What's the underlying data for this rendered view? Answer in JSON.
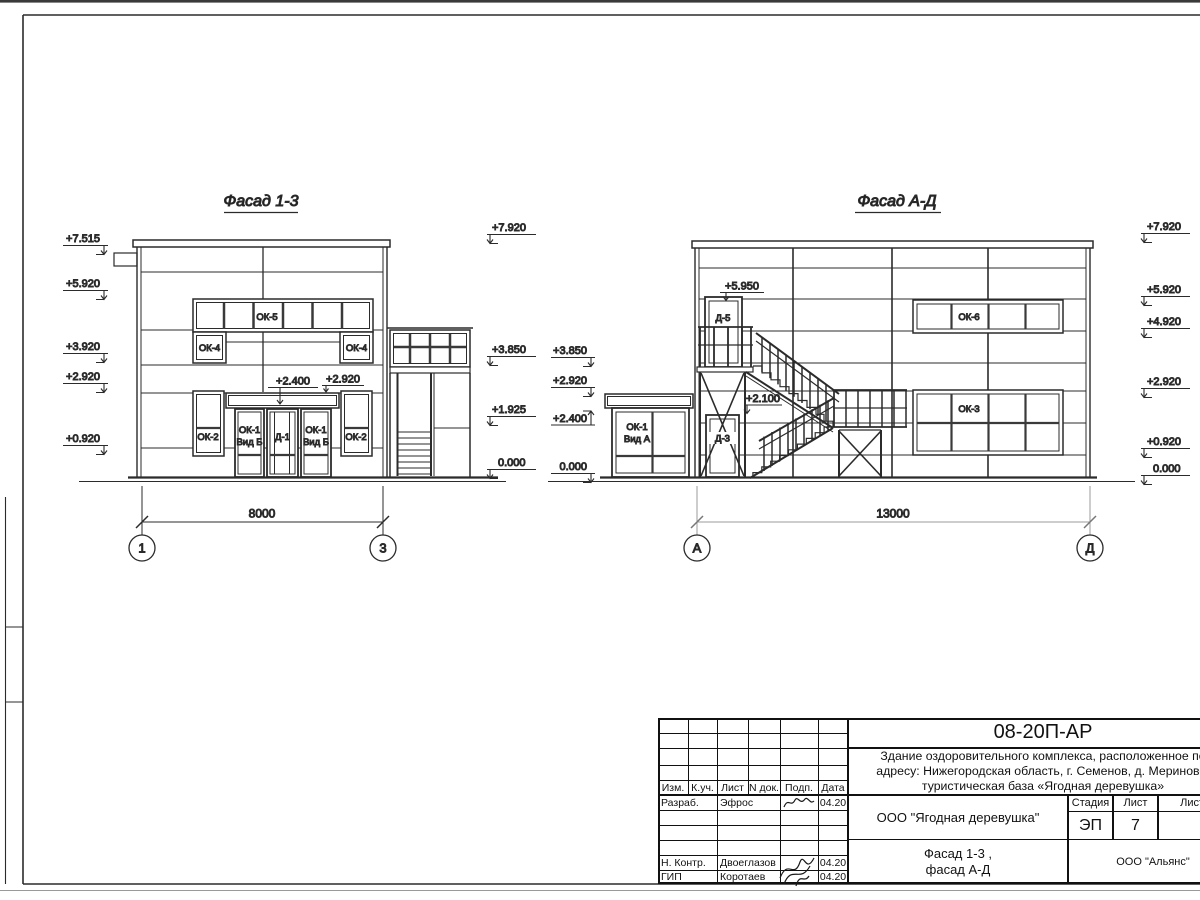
{
  "f13": {
    "title": "Фасад 1-3",
    "marks_left": [
      "+7.515",
      "+5.920",
      "+3.920",
      "+2.920",
      "+0.920"
    ],
    "marks_right": [
      "+7.920",
      "+3.850",
      "+1.925",
      "0.000"
    ],
    "mark_canopy": "+2.400",
    "mark_wall": "+2.920",
    "win_ok5": "ОК-5",
    "win_ok4": "ОК-4",
    "win_ok2": "ОК-2",
    "win_ok1_l1": "ОК-1",
    "win_ok1_l2": "Вид Б",
    "door_d1": "Д-1",
    "dim": "8000",
    "axis_left": "1",
    "axis_right": "3"
  },
  "fad": {
    "title": "Фасад А-Д",
    "marks_left": [
      "+3.850",
      "+2.920",
      "+2.400",
      "0.000"
    ],
    "marks_right": [
      "+7.920",
      "+5.920",
      "+4.920",
      "+2.920",
      "+0.920",
      "0.000"
    ],
    "mark_d5": "+5.950",
    "mark_d3": "+2.100",
    "door_d5": "Д-5",
    "door_d3": "Д-3",
    "win_ok6": "ОК-6",
    "win_ok3": "ОК-3",
    "win_ok1_l1": "ОК-1",
    "win_ok1_l2": "Вид А",
    "dim": "13000",
    "axis_left": "А",
    "axis_right": "Д"
  },
  "stamp": {
    "doc_number": "08-20П-АР",
    "project_l1": "Здание оздоровительного комплекса, расположенное по",
    "project_l2": "адресу: Нижегородская область, г. Семенов, д. Мериново,",
    "project_l3": "туристическая база «Ягодная деревушка»",
    "col_izm": "Изм.",
    "col_kuch": "К.уч.",
    "col_list": "Лист",
    "col_ndok": "N док.",
    "col_podp": "Подп.",
    "col_data": "Дата",
    "rows": [
      {
        "role": "Разраб.",
        "name": "Эфрос",
        "date": "04.20"
      },
      {
        "role": "Н. Контр.",
        "name": "Двоеглазов",
        "date": "04.20"
      },
      {
        "role": "ГИП",
        "name": "Коротаев",
        "date": "04.20"
      }
    ],
    "client": "ООО \"Ягодная деревушка\"",
    "stage_label": "Стадия",
    "sheet_label": "Лист",
    "sheets_label": "Листов",
    "stage": "ЭП",
    "sheet_no": "7",
    "sheet_title_l1": "Фасад 1-3 ,",
    "sheet_title_l2": "фасад А-Д",
    "company": "ООО \"Альянс\""
  }
}
